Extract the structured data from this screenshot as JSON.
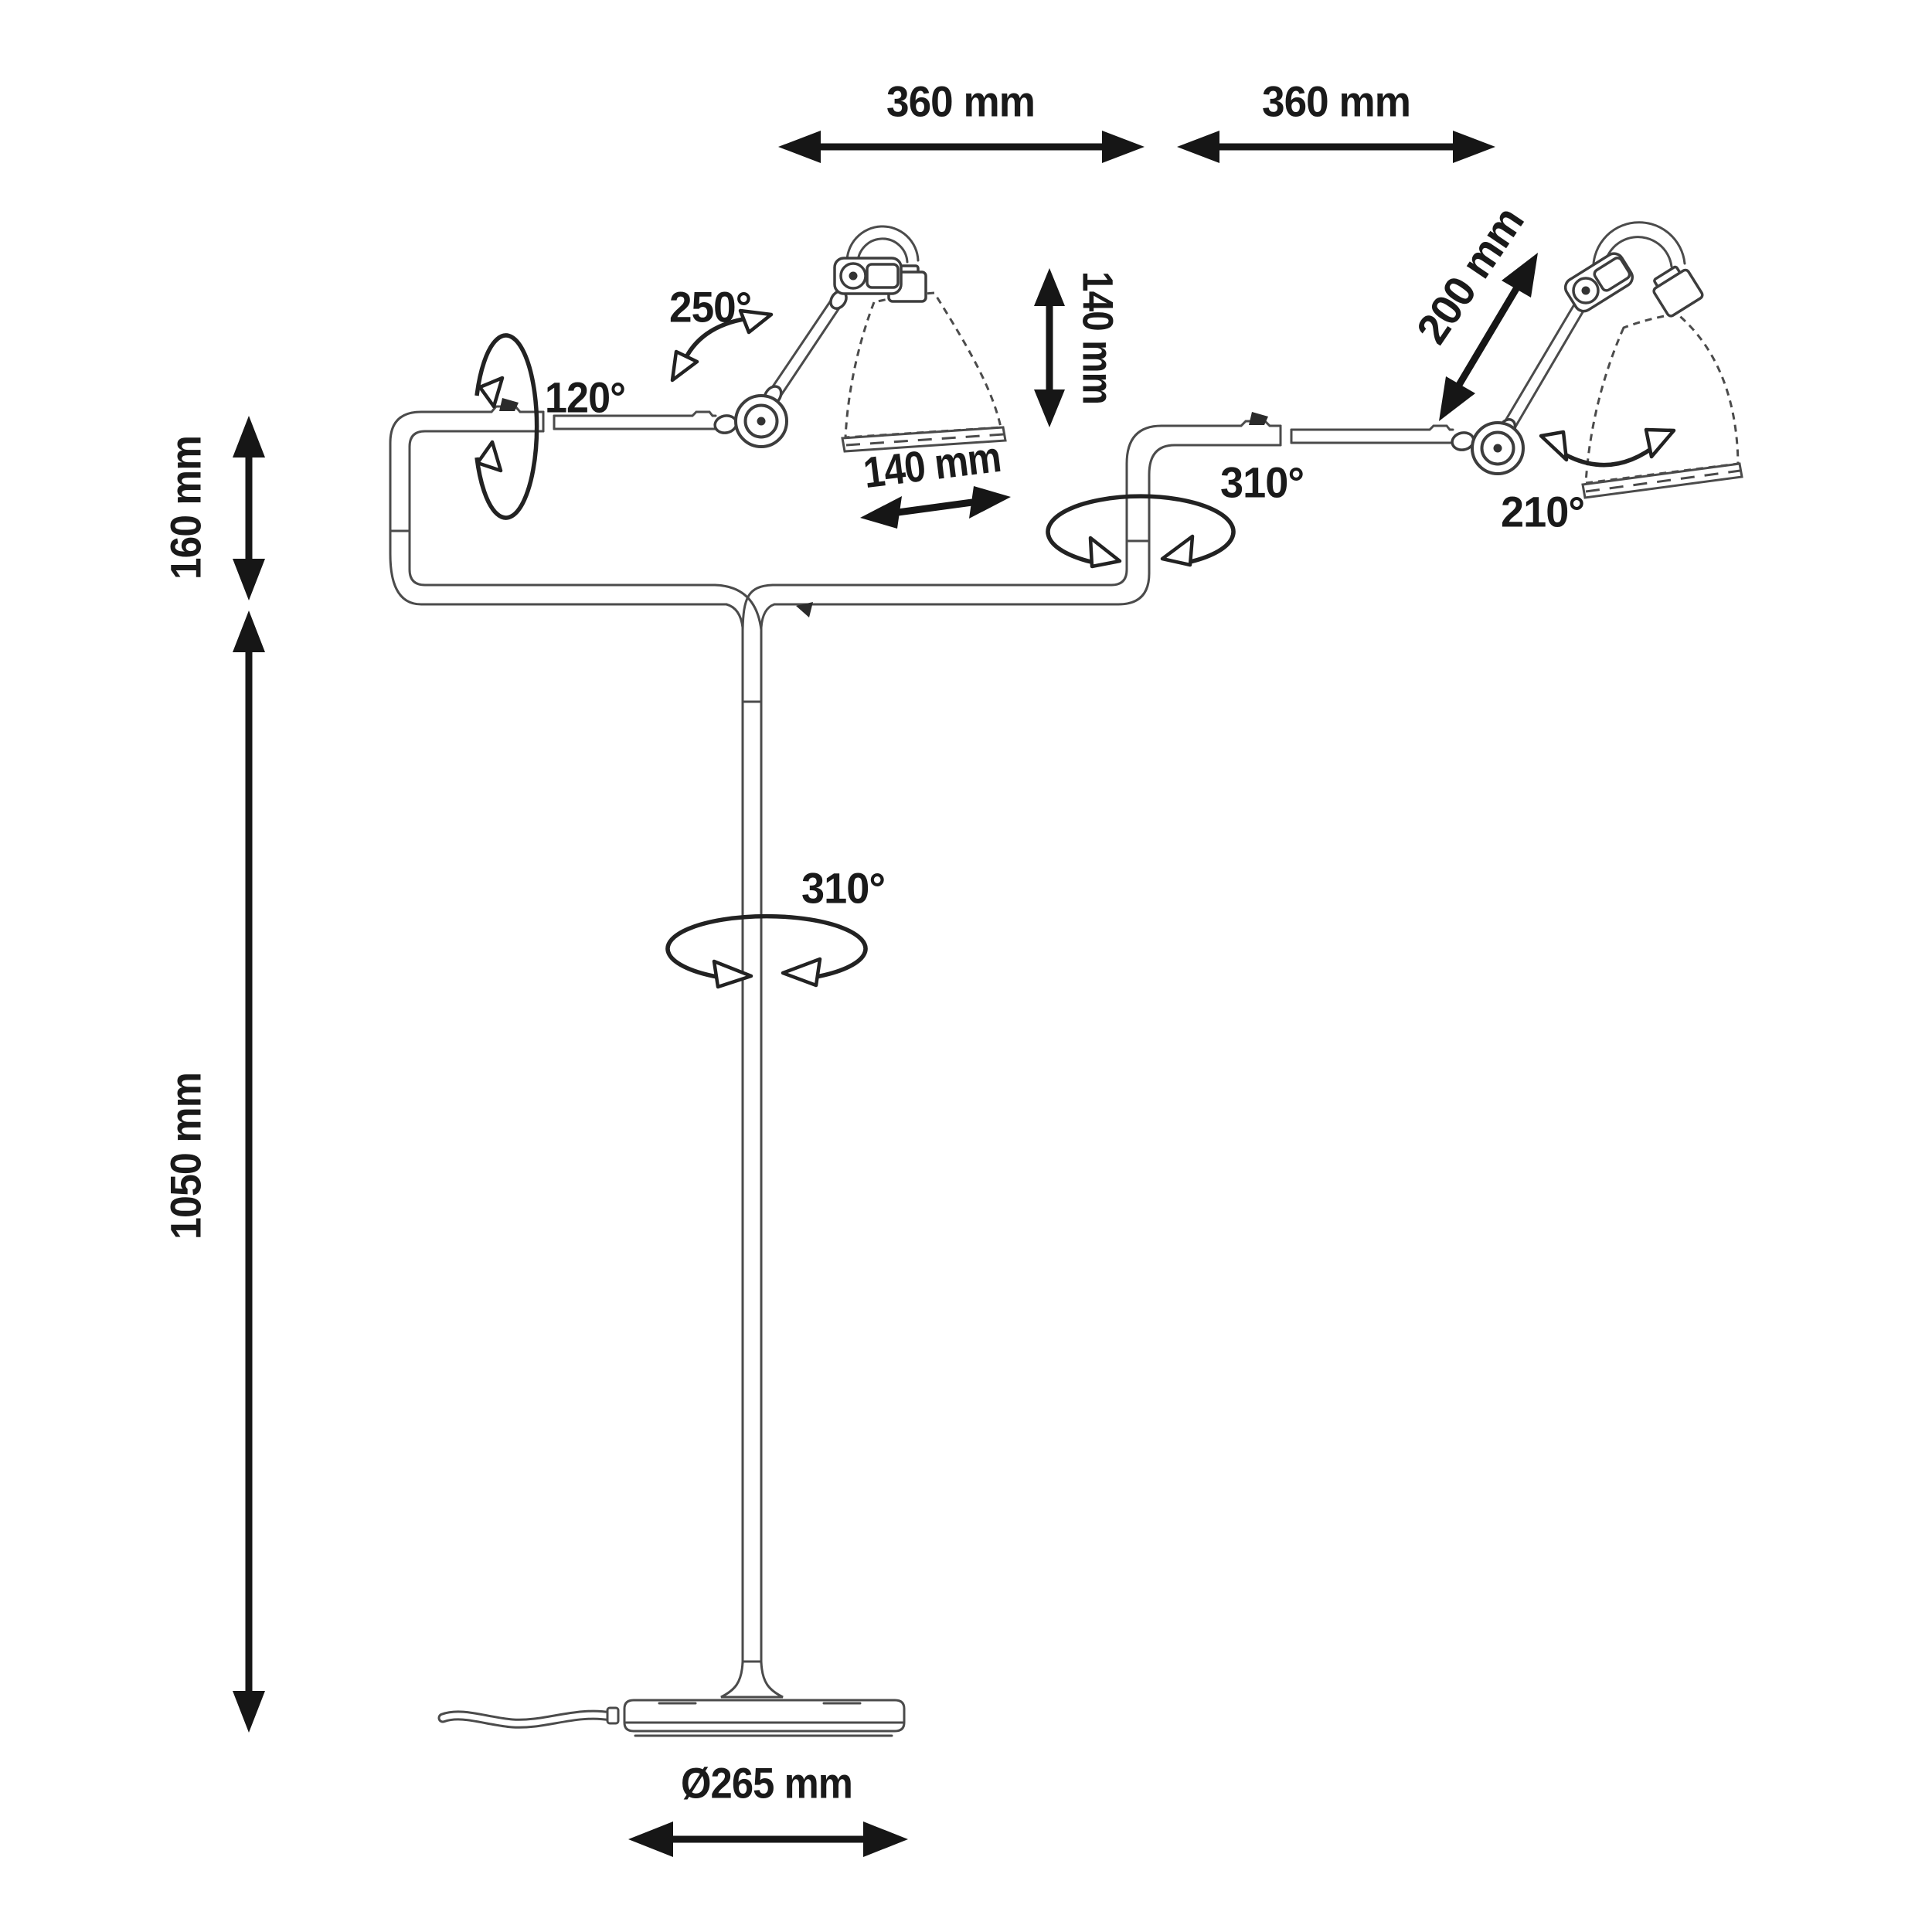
{
  "diagram": {
    "type": "technical-dimension-drawing",
    "subject": "double-arm floor lamp",
    "background": "#ffffff",
    "line_color": "#4b4b4b",
    "annotation_color": "#1a1a1a",
    "labels": {
      "span_left": "360 mm",
      "span_right": "360 mm",
      "upper_height": "160 mm",
      "pole_height": "1050 mm",
      "shade_height": "140 mm",
      "shade_width": "140 mm",
      "arm_length": "200 mm",
      "base_diameter": "Ø265 mm",
      "rotation_arm_axis": "120°",
      "rotation_elbow": "250°",
      "rotation_arm_riser": "310°",
      "rotation_pole": "310°",
      "rotation_shade": "210°"
    }
  }
}
